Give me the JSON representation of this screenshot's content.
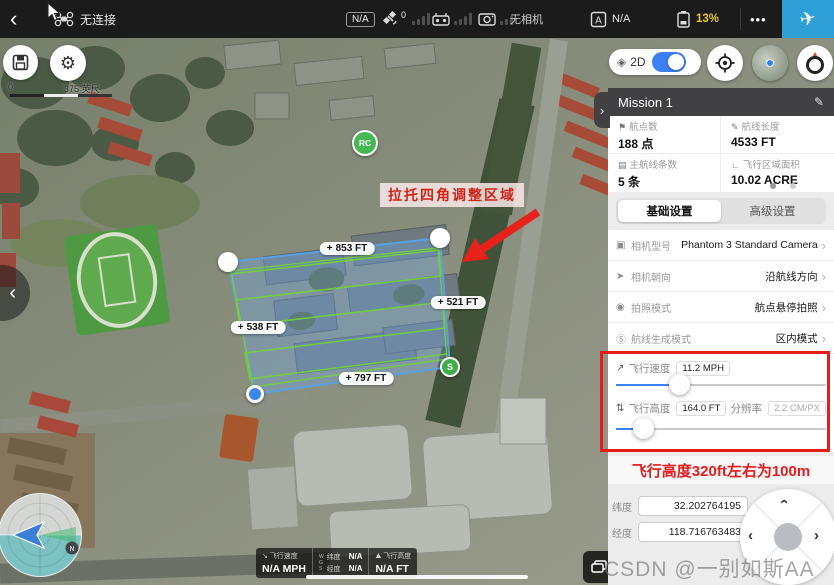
{
  "topbar": {
    "connection_status": "无连接",
    "gps_badge": "N/A",
    "satellite_count": "0",
    "camera_status": "无相机",
    "flight_mode_value": "N/A",
    "battery_percent": "13%"
  },
  "icons": {
    "back": "‹",
    "more": "•••",
    "plane": "✈",
    "edit": "✎",
    "gear": "⚙",
    "layers": "◈",
    "chev_right": "›",
    "chev_left": "‹",
    "save": "▤"
  },
  "map_controls": {
    "scale_zero": "0",
    "scale_label": "375 英尺",
    "view_mode_label": "2D"
  },
  "map": {
    "annotation_text": "拉托四角调整区域",
    "plus_icon": "+",
    "edge_labels": [
      {
        "text": "853 FT"
      },
      {
        "text": "521 FT"
      },
      {
        "text": "538 FT"
      },
      {
        "text": "797 FT"
      }
    ],
    "rc_marker_label": "RC",
    "start_marker_label": "S",
    "north_badge": "N"
  },
  "telemetry": {
    "speed_label": "飞行速度",
    "speed_value": "N/A MPH",
    "wgs_w": "W",
    "wgs_g": "G",
    "wgs_s": "S",
    "lat_label": "纬度",
    "lat_value": "N/A",
    "lng_label": "经度",
    "lng_value": "N/A",
    "alt_label": "飞行高度",
    "alt_value": "N/A FT"
  },
  "panel": {
    "title": "Mission 1",
    "stats": [
      {
        "icon": "⚑",
        "label": "航点数",
        "value": "188 点"
      },
      {
        "icon": "✎",
        "label": "航线长度",
        "value": "4533 FT"
      },
      {
        "icon": "▤",
        "label": "主航线条数",
        "value": "5 条"
      },
      {
        "icon": "∟",
        "label": "飞行区域面积",
        "value": "10.02 ACRE"
      }
    ],
    "tabs": [
      {
        "label": "基础设置"
      },
      {
        "label": "高级设置"
      }
    ],
    "settings": [
      {
        "icon": "▣",
        "label": "相机型号",
        "value": "Phantom 3 Standard Camera"
      },
      {
        "icon": "➤",
        "label": "相机朝向",
        "value": "沿航线方向"
      },
      {
        "icon": "◉",
        "label": "拍照模式",
        "value": "航点悬停拍照"
      },
      {
        "icon": "Ⓢ",
        "label": "航线生成模式",
        "value": "区内模式"
      }
    ],
    "speed_slider": {
      "icon": "↗",
      "label": "飞行速度",
      "value": "11.2 MPH"
    },
    "alt_slider": {
      "icon": "⇅",
      "label": "飞行高度",
      "value": "164.0 FT",
      "res_label": "分辨率",
      "res_value": "2.2 CM/PX"
    },
    "red_note": "飞行高度320ft左右为100m",
    "coords": {
      "lat_label": "纬度",
      "lat_value": "32.202764195",
      "lng_label": "经度",
      "lng_value": "118.716763483"
    }
  },
  "watermark": "CSDN @一别如斯AA"
}
